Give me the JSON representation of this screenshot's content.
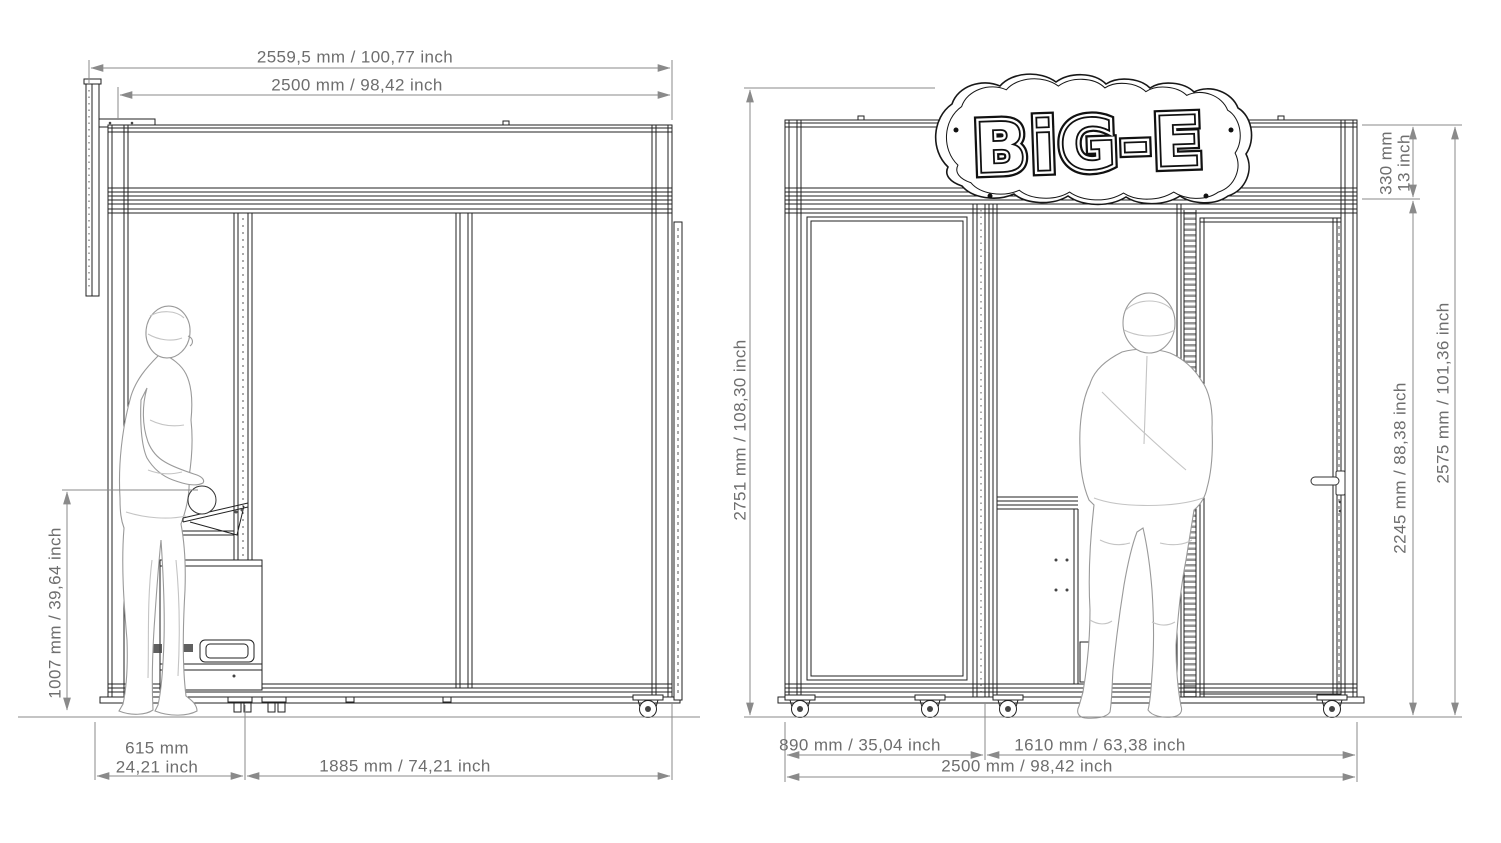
{
  "logo": {
    "text": "BiG-E"
  },
  "colors": {
    "line": "#222222",
    "dim_line": "#8a8a8a",
    "dim_text": "#6e6e6e",
    "figure": "#9a9a9a",
    "background": "#ffffff"
  },
  "side_view": {
    "dims": {
      "overall_width": "2559,5 mm / 100,77 inch",
      "body_width": "2500 mm / 98,42 inch",
      "console_height": "1007 mm / 39,64 inch",
      "console_depth_mm": "615 mm",
      "console_depth_inch": "24,21 inch",
      "panel_width": "1885 mm / 74,21 inch"
    }
  },
  "front_view": {
    "dims": {
      "total_height": "2751 mm / 108,30 inch",
      "sign_band_height_mm": "330 mm",
      "sign_band_height_inch": "13 inch",
      "door_section_height": "2245 mm / 88,38 inch",
      "body_height": "2575 mm / 101,36 inch",
      "left_bay_width": "890 mm / 35,04 inch",
      "right_bay_width": "1610 mm / 63,38 inch",
      "total_width": "2500 mm / 98,42 inch"
    }
  }
}
